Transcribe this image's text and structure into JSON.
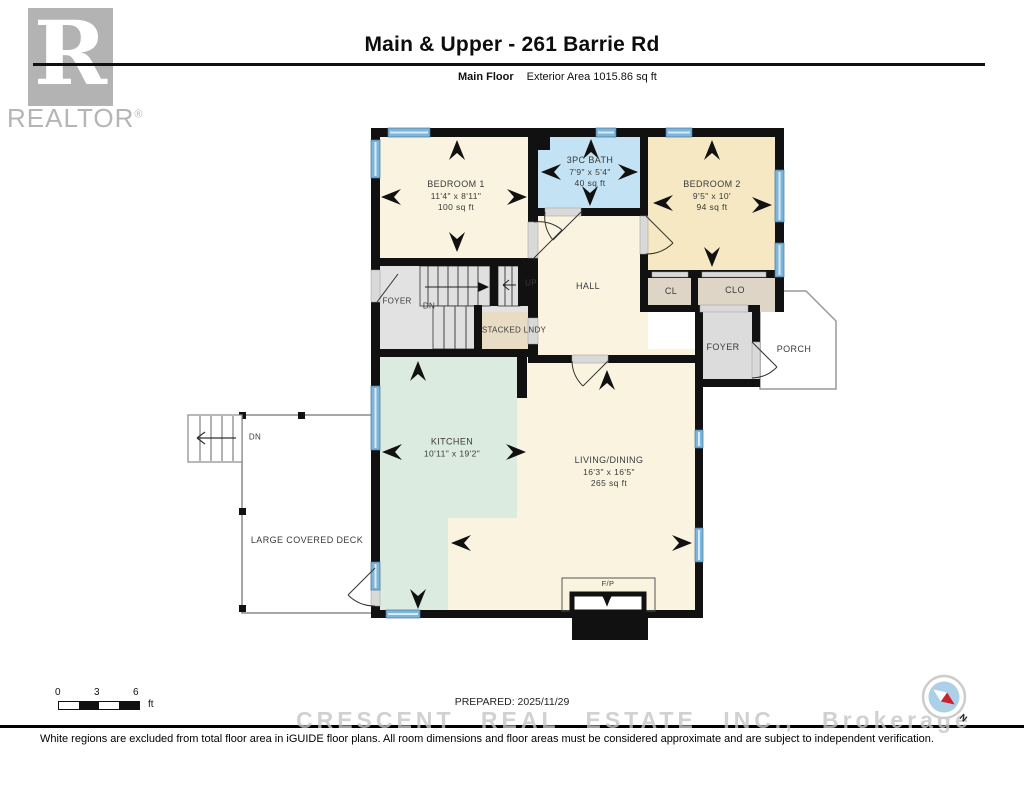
{
  "header": {
    "realtor_letter": "R",
    "realtor_brand": "REALTOR",
    "realtor_reg": "®",
    "title": "Main & Upper - 261 Barrie Rd",
    "floor_label": "Main Floor",
    "exterior_area": "Exterior Area 1015.86 sq ft"
  },
  "rooms": {
    "bedroom1": {
      "name": "BEDROOM 1",
      "dims": "11'4\" x 8'11\"",
      "area": "100 sq ft"
    },
    "bath": {
      "name": "3PC BATH",
      "dims": "7'9\" x 5'4\"",
      "area": "40 sq ft"
    },
    "bedroom2": {
      "name": "BEDROOM 2",
      "dims": "9'5\" x 10'",
      "area": "94 sq ft"
    },
    "foyer_left": {
      "name": "FOYER"
    },
    "hall": {
      "name": "HALL"
    },
    "cl": {
      "name": "CL"
    },
    "clo": {
      "name": "CLO"
    },
    "stacked_lndy": {
      "name": "STACKED LNDY"
    },
    "foyer_right": {
      "name": "FOYER"
    },
    "porch": {
      "name": "PORCH"
    },
    "kitchen": {
      "name": "KITCHEN",
      "dims": "10'11\" x 19'2\""
    },
    "living_dining": {
      "name": "LIVING/DINING",
      "dims": "16'3\" x 16'5\"",
      "area": "265 sq ft"
    },
    "deck": {
      "name": "LARGE COVERED DECK"
    },
    "fireplace": {
      "name": "F/P"
    }
  },
  "stairs": {
    "up": "UP",
    "down": "DN",
    "deck_down": "DN"
  },
  "scale_bar": {
    "tick0": "0",
    "tick1": "3",
    "tick2": "6",
    "unit": "ft"
  },
  "footer": {
    "prepared": "PREPARED: 2025/11/29",
    "watermark": "CRESCENT REAL ESTATE INC., Brokerage",
    "disclaimer": "White regions are excluded from total floor area in iGUIDE floor plans. All room dimensions and floor areas must be considered approximate and are subject to independent verification."
  },
  "compass": {
    "north": "N"
  },
  "colors": {
    "room_cream": "#faf3e0",
    "bedroom2_tan": "#f6e8c3",
    "bath_blue": "#c3e2f4",
    "kitchen_mint": "#dcebdf",
    "closet_tan": "#ded5c6",
    "laundry_tan": "#e9dcc4",
    "stair_gray": "#e2e2e2",
    "wall_black": "#111111",
    "window_blue": "#7eb6da",
    "compass_blue": "#abd0e8",
    "compass_red": "#c9242b",
    "logo_gray": "#b3b3b3"
  }
}
